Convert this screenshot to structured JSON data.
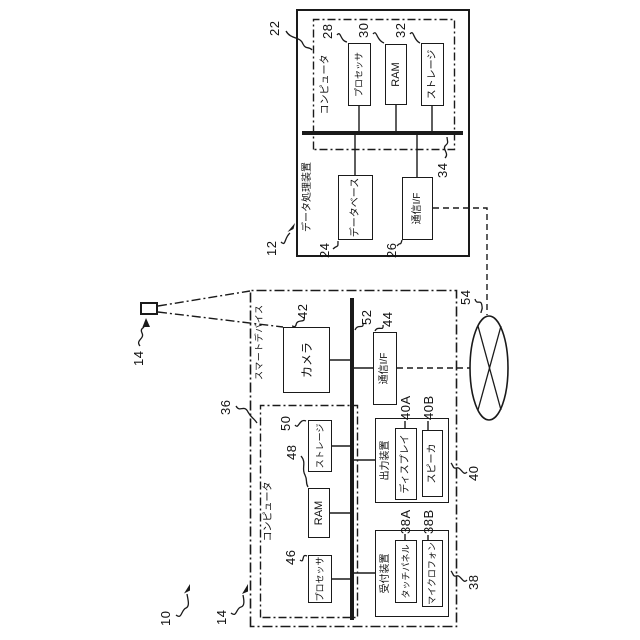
{
  "figure": {
    "system": {
      "ref": "10"
    },
    "smart_device": {
      "ref": "14",
      "label": "スマートデバイス",
      "computer": {
        "label": "コンピュータ",
        "ref": "36"
      },
      "processor": {
        "label": "プロセッサ",
        "ref": "46"
      },
      "ram": {
        "label": "RAM",
        "ref": "48"
      },
      "storage": {
        "label": "ストレージ",
        "ref": "50"
      },
      "camera": {
        "label": "カメラ",
        "ref": "42"
      },
      "bus_ref": "52",
      "comm_if": {
        "label": "通信I/F",
        "ref": "44"
      },
      "output_device": {
        "label": "出力装置",
        "ref": "40"
      },
      "display": {
        "label": "ディスプレイ",
        "ref": "40A"
      },
      "speaker": {
        "label": "スピーカ",
        "ref": "40B"
      },
      "reception_device": {
        "label": "受付装置",
        "ref": "38"
      },
      "touch_panel": {
        "label": "タッチパネル",
        "ref": "38A"
      },
      "microphone": {
        "label": "マイクロフォン",
        "ref": "38B"
      }
    },
    "data_processing_device": {
      "ref": "12",
      "label": "データ処理装置",
      "computer": {
        "label": "コンピュータ",
        "ref": "22"
      },
      "processor": {
        "label": "プロセッサ",
        "ref": "28"
      },
      "ram": {
        "label": "RAM",
        "ref": "30"
      },
      "storage": {
        "label": "ストレージ",
        "ref": "32"
      },
      "bus_ref": "34",
      "database": {
        "label": "データベース",
        "ref": "24"
      },
      "comm_if": {
        "label": "通信I/F",
        "ref": "26"
      }
    },
    "network": {
      "ref": "54"
    }
  }
}
